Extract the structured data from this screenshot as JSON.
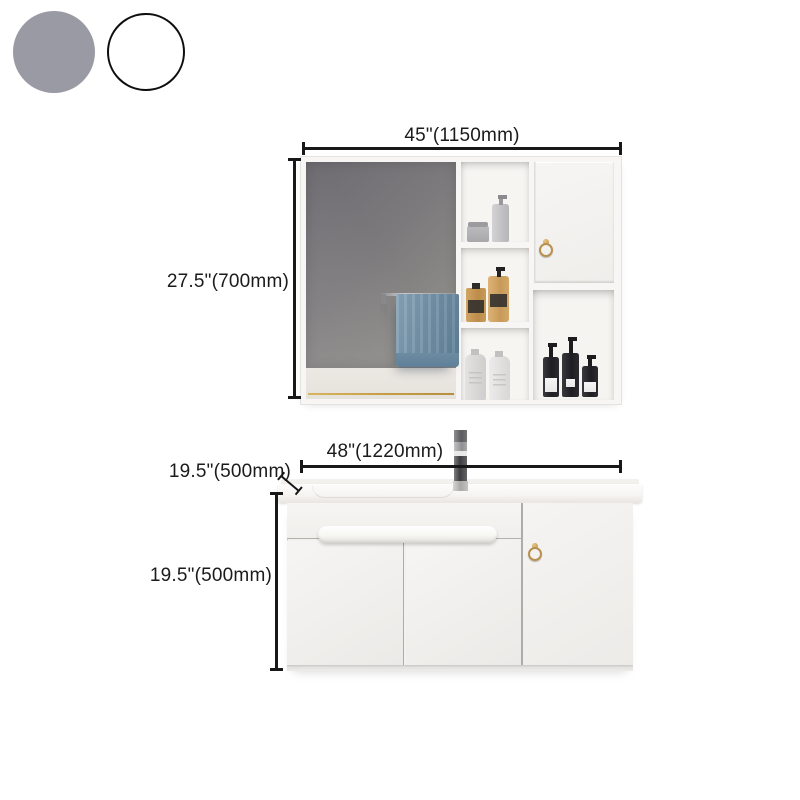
{
  "color_options": {
    "gray_hex": "#999AA4",
    "white_hex": "#FFFFFF"
  },
  "mirror_cabinet": {
    "width_label": "45\"(1150mm)",
    "height_label": "27.5\"(700mm)"
  },
  "vanity": {
    "width_label": "48\"(1220mm)",
    "depth_label": "19.5\"(500mm)",
    "height_label": "19.5\"(500mm)"
  },
  "accent_colors": {
    "dimension_ink": "#181818",
    "gold_hardware": "#B8904F",
    "towel_blue": "#7795AB",
    "cabinet_white": "#F3F2F0"
  }
}
